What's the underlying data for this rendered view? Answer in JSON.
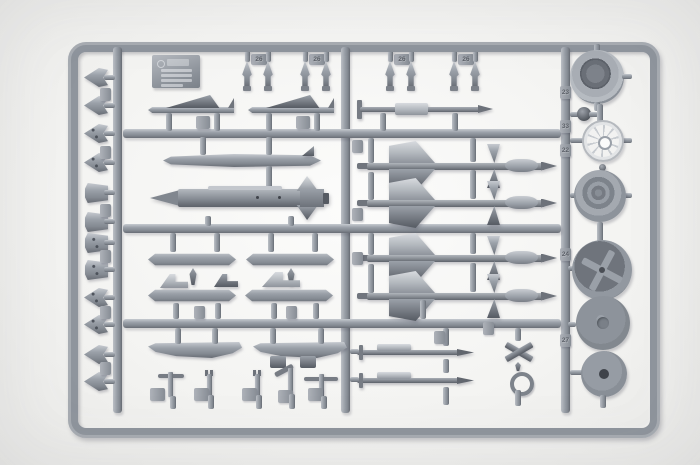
{
  "image": {
    "type": "photograph",
    "subject": "grey injection-moulded model kit sprue with aircraft ordnance, pylons and wheels",
    "plastic_color": "#9aa0a8",
    "plastic_dark": "#61666e",
    "plastic_light": "#c6cad0",
    "background_color": "#f3f3f1"
  },
  "tabs": {
    "top": [
      "26",
      "26",
      "26",
      "26"
    ],
    "right": [
      "23",
      "33",
      "22",
      "24",
      "27"
    ]
  },
  "parts_inventory": [
    {
      "name": "arrow-shaped fins (left column)",
      "count": 12
    },
    {
      "name": "small bomblets (top row)",
      "count": 8
    },
    {
      "name": "winged glide bombs",
      "count": 2
    },
    {
      "name": "unguided rocket with sleeve",
      "count": 1
    },
    {
      "name": "drop tank",
      "count": 1
    },
    {
      "name": "large missile with cruciform tail",
      "count": 1
    },
    {
      "name": "delta-wing air-to-air missiles",
      "count": 4
    },
    {
      "name": "weapon pylon racks",
      "count": 4
    },
    {
      "name": "launch rails",
      "count": 2
    },
    {
      "name": "slim rockets with fairing",
      "count": 2
    },
    {
      "name": "cruciform fin unit",
      "count": 1
    },
    {
      "name": "ring fitting",
      "count": 1
    },
    {
      "name": "small fittings (bottom row)",
      "count": 5
    },
    {
      "name": "main wheels",
      "count": 3
    },
    {
      "name": "spoked hub",
      "count": 1
    },
    {
      "name": "hub discs",
      "count": 2
    },
    {
      "name": "ball joint",
      "count": 1
    },
    {
      "name": "maker plate",
      "count": 1
    }
  ]
}
